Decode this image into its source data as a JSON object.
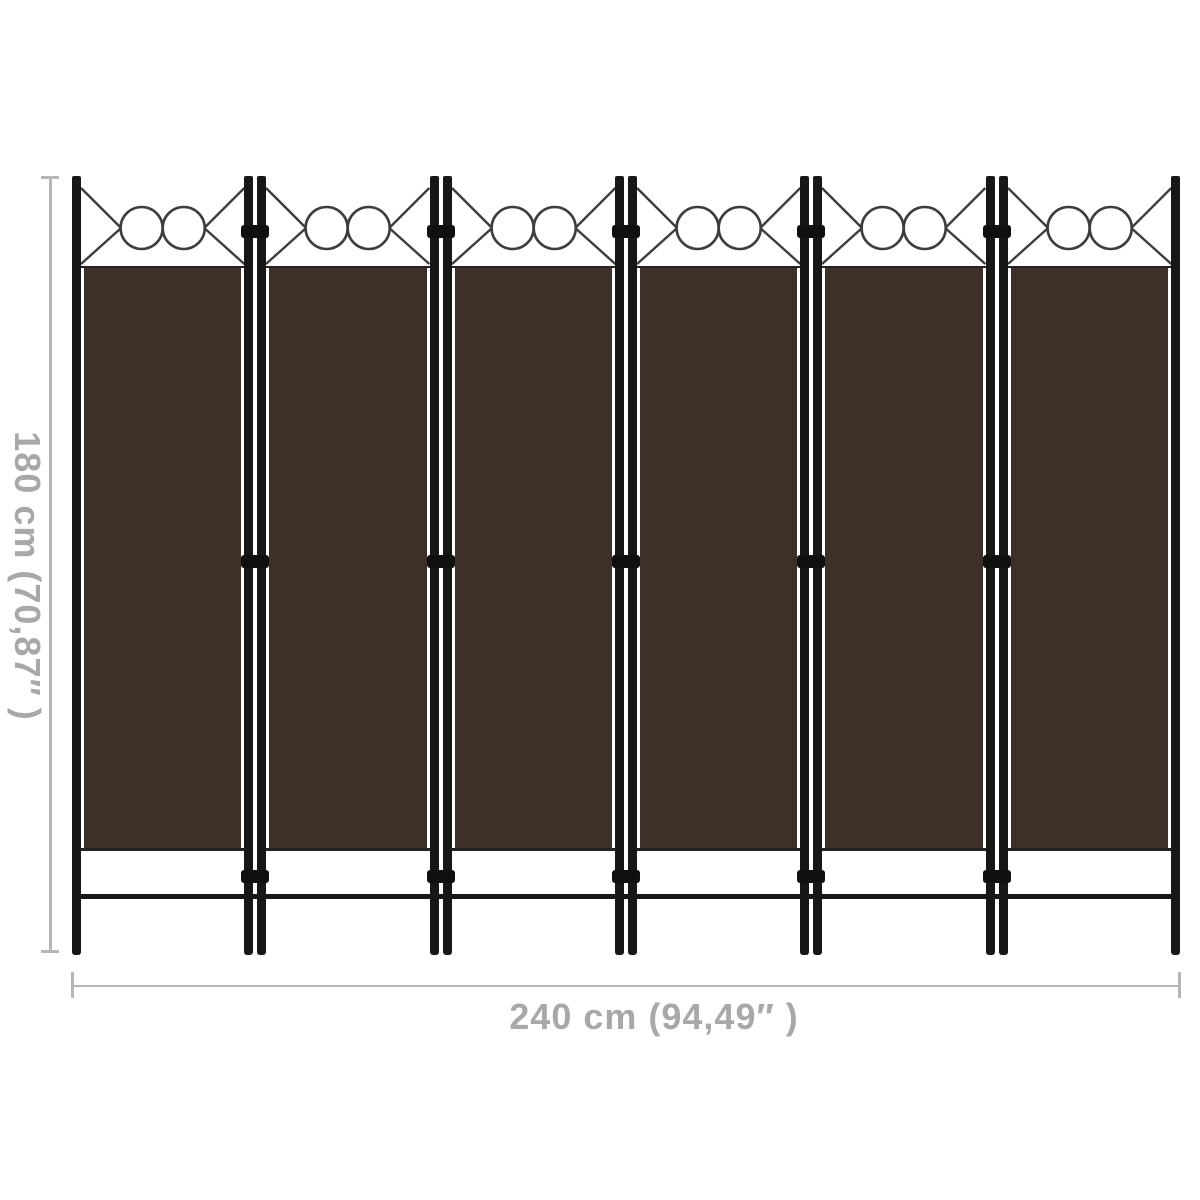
{
  "product": {
    "name": "room-divider",
    "panel_count": 6,
    "junction_hinge_count": 3,
    "colors": {
      "fabric": "#3c3029",
      "frame": "#171717",
      "ornament": "#3d3d3d",
      "background": "#ffffff"
    }
  },
  "dimensions": {
    "height_label": "180 cm (70,87″ )",
    "width_label": "240 cm (94,49″ )",
    "line_color": "#b6b6b6",
    "text_color": "#a8a8a8"
  }
}
